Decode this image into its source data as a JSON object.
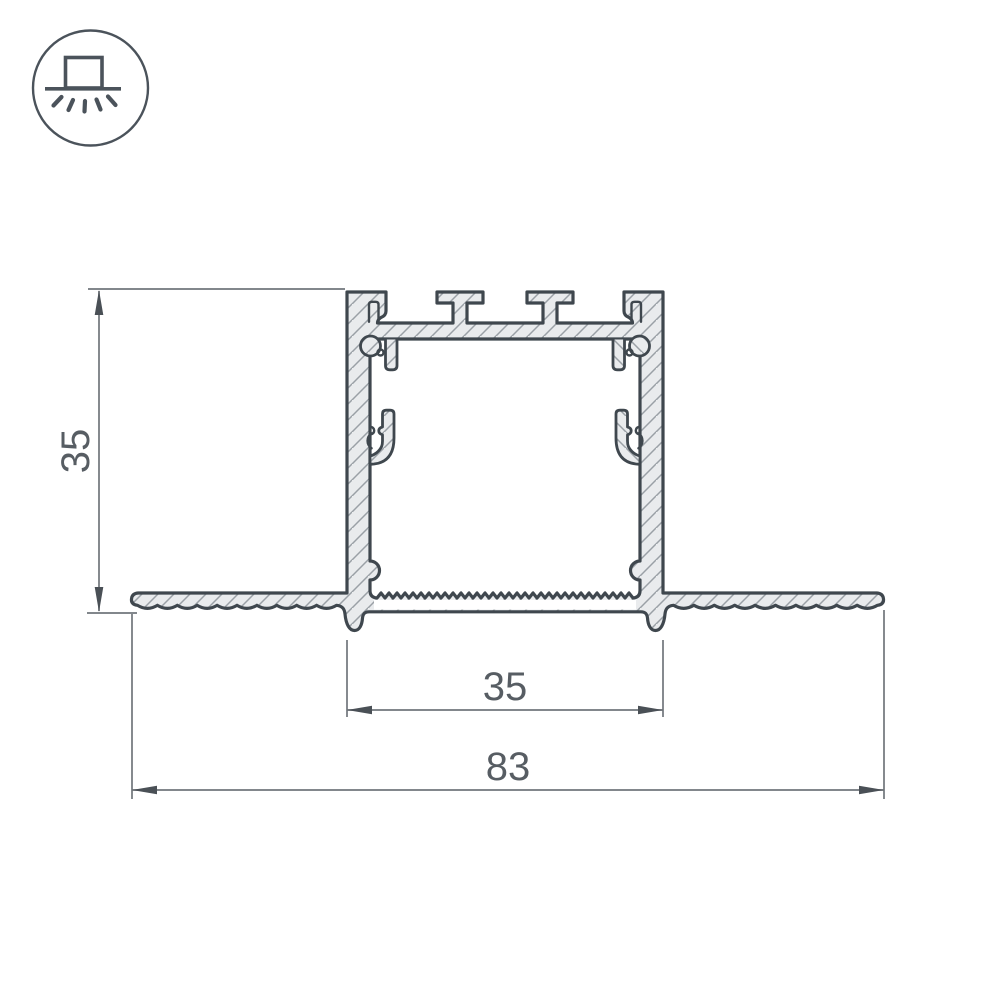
{
  "drawing": {
    "title": "recessed-aluminium-led-profile-cross-section",
    "dimensions": {
      "height": "35",
      "inner_width": "35",
      "overall_width": "83"
    },
    "colors": {
      "outline": "#3f474e",
      "metal_fill": "#e9ebed",
      "hatch_line": "#9aa0a6",
      "dimension_line": "#70767b",
      "dimension_text": "#575d63",
      "icon": "#4b535b",
      "background": "#ffffff"
    }
  },
  "icon": {
    "name": "recessed-downlight-mount",
    "parts": [
      "circle-border",
      "fixture-box",
      "ceiling-line",
      "light-rays"
    ]
  }
}
